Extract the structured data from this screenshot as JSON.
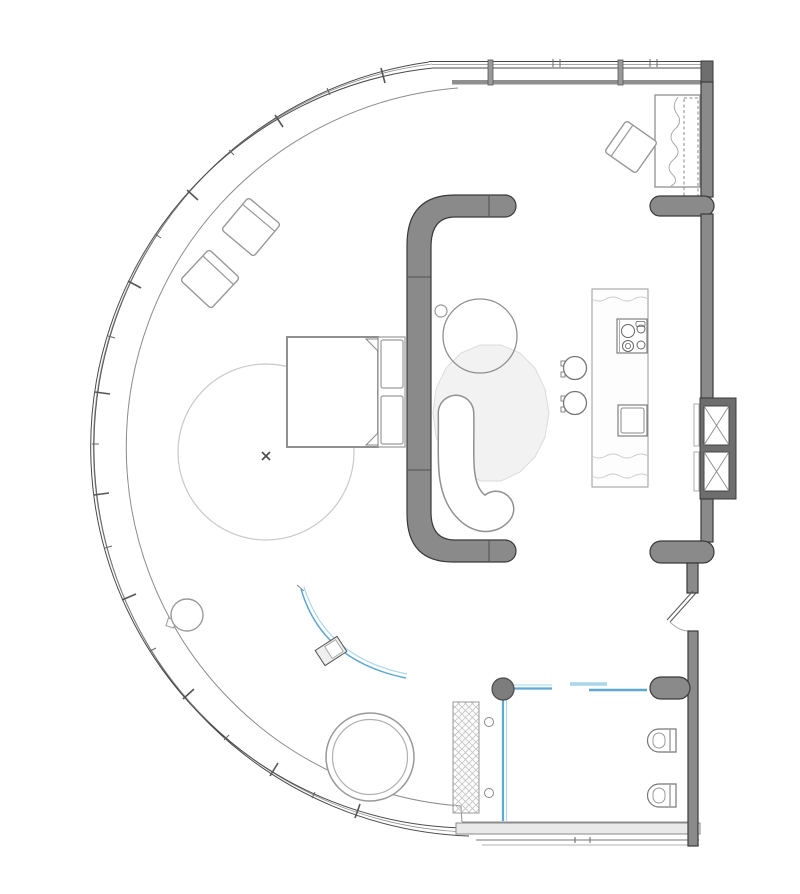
{
  "meta": {
    "drawing_type": "apartment floor plan",
    "visible_text": ""
  },
  "colors": {
    "background": "#ffffff",
    "wall_fill": "#8a8a8a",
    "wall_fill_dark": "#6e6e6e",
    "wall_outline": "#3a3a3a",
    "line_dark": "#4a4a4a",
    "line_mid": "#8c8c8c",
    "line_light": "#c9c9c9",
    "furniture_stroke": "#989898",
    "rug_fill": "#f2f2f2",
    "rug_stroke": "#dcdcdc",
    "glass_blue": "#5fa8d0",
    "glass_blue_light": "#a9d6ec",
    "band_fill": "#e9e9e9",
    "hatch": "#c4c4c4"
  },
  "fixtures": [
    "curved-window-wall",
    "top-window-wall",
    "right-wall",
    "media-wall",
    "lounge-chair",
    "lounge-chair",
    "desk",
    "desk-chair",
    "bed",
    "round-rug",
    "center-mark",
    "coffee-table",
    "side-table",
    "sofa",
    "area-rug",
    "kitchen-island",
    "cooktop",
    "kitchen-sink",
    "bar-stool",
    "bar-stool",
    "service-shaft",
    "service-shaft",
    "entry-door",
    "curtain-track",
    "tv-unit",
    "floor-lamp",
    "bathtub",
    "shower-mat",
    "floor-drain",
    "floor-drain",
    "toilet",
    "bidet",
    "glass-partition",
    "sliding-door",
    "round-column"
  ]
}
